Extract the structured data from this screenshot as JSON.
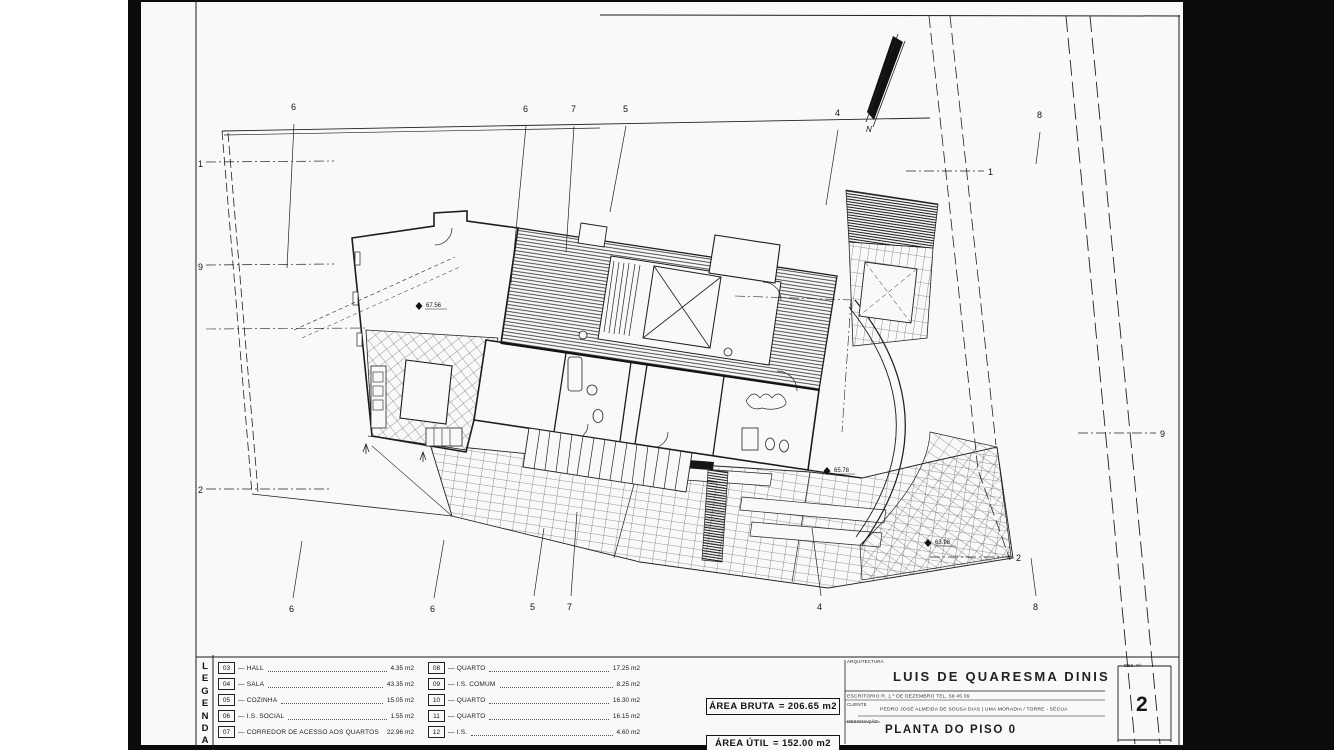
{
  "sheet": {
    "discipline_label": "ARQUITECTURA",
    "architect_name": "LUIS DE QUARESMA DINIS",
    "office_line": "ESCRITORIO   R. 1.º DE DEZEMBRO   TEL. 59 45 09",
    "client_label": "CLIENTE",
    "client_line": "PEDRO JOSÉ ALMEIDA DE SOUSA DIAS | UMA MORADIA / TORRE - SÉCUA",
    "designation_label": "DESIGNAÇÃO",
    "designation": "PLANTA DO PISO 0",
    "number_label": "DES. Nº",
    "number": "2"
  },
  "legend": {
    "title": "LEGENDA",
    "title_letters": [
      "L",
      "E",
      "G",
      "E",
      "N",
      "D",
      "A"
    ],
    "items": [
      {
        "code": "03",
        "name": "HALL",
        "area": "4.35 m2"
      },
      {
        "code": "04",
        "name": "SALA",
        "area": "43.35 m2"
      },
      {
        "code": "05",
        "name": "COZINHA",
        "area": "15.05 m2"
      },
      {
        "code": "06",
        "name": "I.S. SOCIAL",
        "area": "1.55 m2"
      },
      {
        "code": "07",
        "name": "CORREDOR DE ACESSO AOS QUARTOS",
        "area": "22.96 m2"
      },
      {
        "code": "08",
        "name": "QUARTO",
        "area": "17.25 m2"
      },
      {
        "code": "09",
        "name": "I.S. COMUM",
        "area": "8.25 m2"
      },
      {
        "code": "10",
        "name": "QUARTO",
        "area": "16.30 m2"
      },
      {
        "code": "11",
        "name": "QUARTO",
        "area": "16.15 m2"
      },
      {
        "code": "12",
        "name": "I.S.",
        "area": "4.60 m2"
      }
    ]
  },
  "areas": {
    "bruta_label": "ÁREA BRUTA",
    "bruta_value": "= 206.65 m2",
    "util_label": "ÁREA ÚTIL",
    "util_value": "= 152.00 m2"
  },
  "plan": {
    "north_label": "N",
    "ink_color": "#1c1c1c",
    "paper_color": "#f9f9f7",
    "grid_labels": [
      {
        "label": "6",
        "tx": 291,
        "ty": 110,
        "x1": 294,
        "y1": 124,
        "x2": 287,
        "y2": 268,
        "axis": "v"
      },
      {
        "label": "6",
        "tx": 523,
        "ty": 112,
        "x1": 526,
        "y1": 126,
        "x2": 511,
        "y2": 283,
        "axis": "v"
      },
      {
        "label": "7",
        "tx": 571,
        "ty": 112,
        "x1": 574,
        "y1": 126,
        "x2": 566,
        "y2": 252,
        "axis": "v"
      },
      {
        "label": "5",
        "tx": 623,
        "ty": 112,
        "x1": 626,
        "y1": 126,
        "x2": 610,
        "y2": 212,
        "axis": "v"
      },
      {
        "label": "4",
        "tx": 835,
        "ty": 116,
        "x1": 838,
        "y1": 130,
        "x2": 826,
        "y2": 205,
        "axis": "v"
      },
      {
        "label": "8",
        "tx": 1037,
        "ty": 118,
        "x1": 1040,
        "y1": 132,
        "x2": 1036,
        "y2": 164,
        "axis": "v"
      },
      {
        "label": "6",
        "tx": 289,
        "ty": 612,
        "x1": 293,
        "y1": 598,
        "x2": 302,
        "y2": 541,
        "axis": "v"
      },
      {
        "label": "6",
        "tx": 430,
        "ty": 612,
        "x1": 434,
        "y1": 598,
        "x2": 444,
        "y2": 540,
        "axis": "v"
      },
      {
        "label": "5",
        "tx": 530,
        "ty": 610,
        "x1": 534,
        "y1": 596,
        "x2": 544,
        "y2": 528,
        "axis": "v"
      },
      {
        "label": "7",
        "tx": 567,
        "ty": 610,
        "x1": 571,
        "y1": 596,
        "x2": 577,
        "y2": 512,
        "axis": "v"
      },
      {
        "label": "4",
        "tx": 817,
        "ty": 610,
        "x1": 821,
        "y1": 596,
        "x2": 812,
        "y2": 528,
        "axis": "v"
      },
      {
        "label": "8",
        "tx": 1033,
        "ty": 610,
        "x1": 1036,
        "y1": 596,
        "x2": 1031,
        "y2": 558,
        "axis": "v"
      },
      {
        "label": "1",
        "tx": 198,
        "ty": 167,
        "x1": 206,
        "y1": 162,
        "x2": 334,
        "y2": 161,
        "axis": "h"
      },
      {
        "label": "9",
        "tx": 198,
        "ty": 270,
        "x1": 206,
        "y1": 265,
        "x2": 334,
        "y2": 264,
        "axis": "h"
      },
      {
        "label": "2",
        "tx": 198,
        "ty": 493,
        "x1": 206,
        "y1": 489,
        "x2": 330,
        "y2": 489,
        "axis": "h"
      },
      {
        "label": "1",
        "tx": 988,
        "ty": 175,
        "x1": 906,
        "y1": 171,
        "x2": 984,
        "y2": 171,
        "axis": "h"
      },
      {
        "label": "9",
        "tx": 1160,
        "ty": 437,
        "x1": 1078,
        "y1": 433,
        "x2": 1156,
        "y2": 433,
        "axis": "h"
      },
      {
        "label": "2",
        "tx": 1016,
        "ty": 561,
        "x1": 930,
        "y1": 557,
        "x2": 1012,
        "y2": 557,
        "axis": "h"
      }
    ],
    "level_marks": [
      {
        "label": "67.56",
        "x": 419,
        "y": 306
      },
      {
        "label": "65.78",
        "x": 827,
        "y": 471
      },
      {
        "label": "63.98",
        "x": 928,
        "y": 543
      }
    ]
  }
}
